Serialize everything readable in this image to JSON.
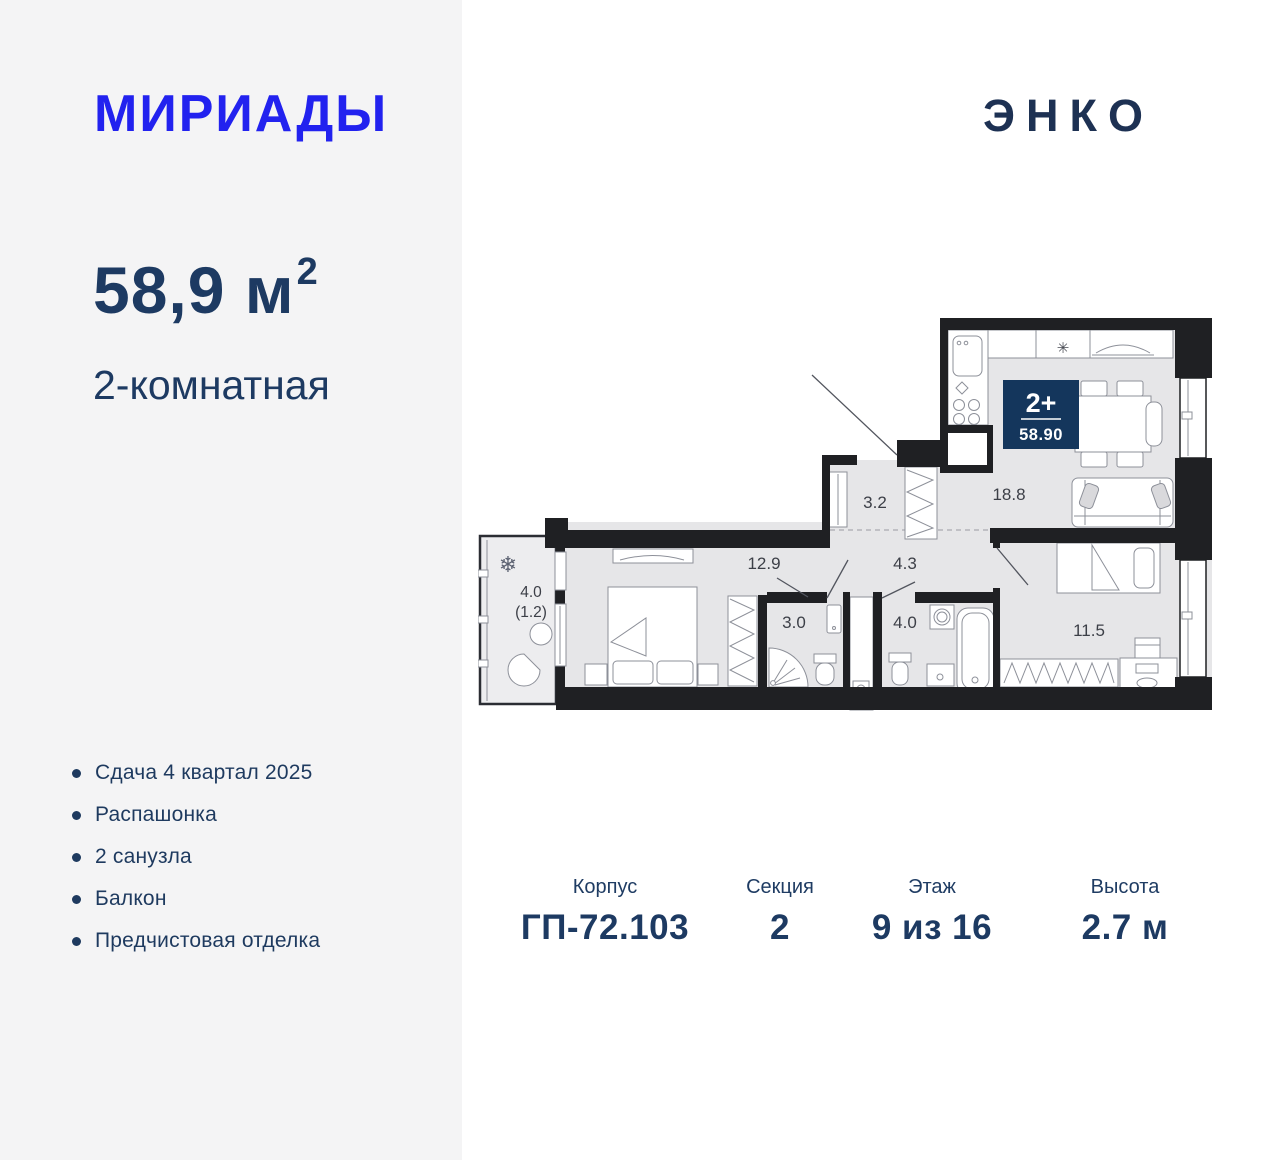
{
  "brand": {
    "project_logo": "МИРИАДЫ",
    "developer_logo": "ЭНКО"
  },
  "apartment": {
    "area": "58,9 м",
    "area_superscript": "2",
    "rooms_type": "2-комнатная"
  },
  "features": [
    {
      "text": "Сдача 4 квартал 2025"
    },
    {
      "text": "Распашонка"
    },
    {
      "text": "2 санузла"
    },
    {
      "text": "Балкон"
    },
    {
      "text": "Предчистовая отделка"
    }
  ],
  "plan": {
    "badge": {
      "rooms": "2+",
      "area": "58.90"
    },
    "room_labels": {
      "hallway": "3.2",
      "kitchen_living": "18.8",
      "bedroom": "12.9",
      "corridor": "4.3",
      "shower_room": "3.0",
      "bathroom": "4.0",
      "bedroom2": "11.5",
      "balcony_total": "4.0",
      "balcony_reduced": "(1.2)"
    },
    "icons": {
      "kitchen_star": "✳",
      "balcony_snowflake": "❄"
    }
  },
  "details": [
    {
      "label": "Корпус",
      "value": "ГП-72.103"
    },
    {
      "label": "Секция",
      "value": "2"
    },
    {
      "label": "Этаж",
      "value": "9 из 16"
    },
    {
      "label": "Высота",
      "value": "2.7 м"
    }
  ],
  "colors": {
    "brand_blue": "#2222ef",
    "navy_text": "#1d3a62",
    "badge_navy": "#14365c",
    "wall_black": "#1f2023",
    "floor_gray": "#e6e6e8",
    "left_panel_gray": "#f4f4f5"
  }
}
